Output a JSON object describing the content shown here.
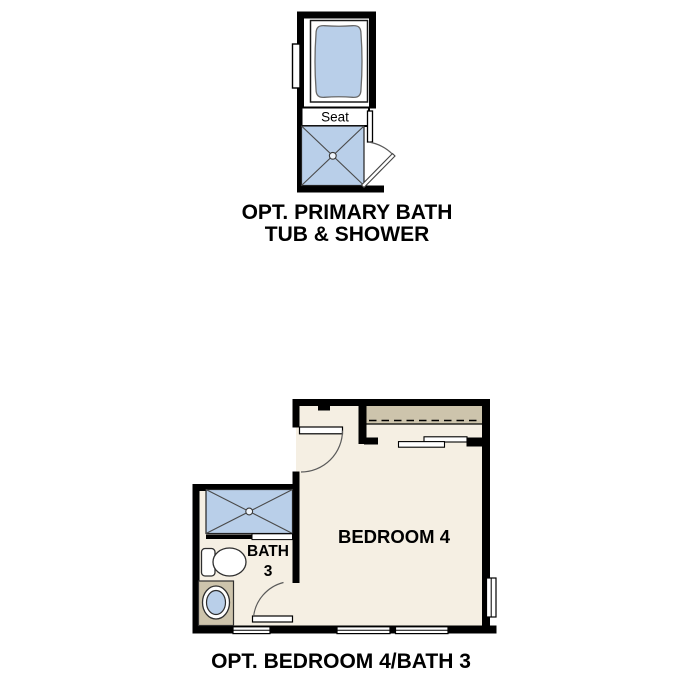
{
  "colors": {
    "wall": "#000000",
    "fixture_blue": "#b9cfe9",
    "floor": "#f5efe3",
    "cabinet": "#cdc4ac"
  },
  "primary_bath_plan": {
    "seat_label": "Seat",
    "title_line1": "OPT. PRIMARY BATH",
    "title_line2": "TUB & SHOWER"
  },
  "bedroom_plan": {
    "bedroom_label": "BEDROOM 4",
    "bath_label_top": "BATH",
    "bath_label_bottom": "3",
    "title": "OPT. BEDROOM 4/BATH 3"
  }
}
